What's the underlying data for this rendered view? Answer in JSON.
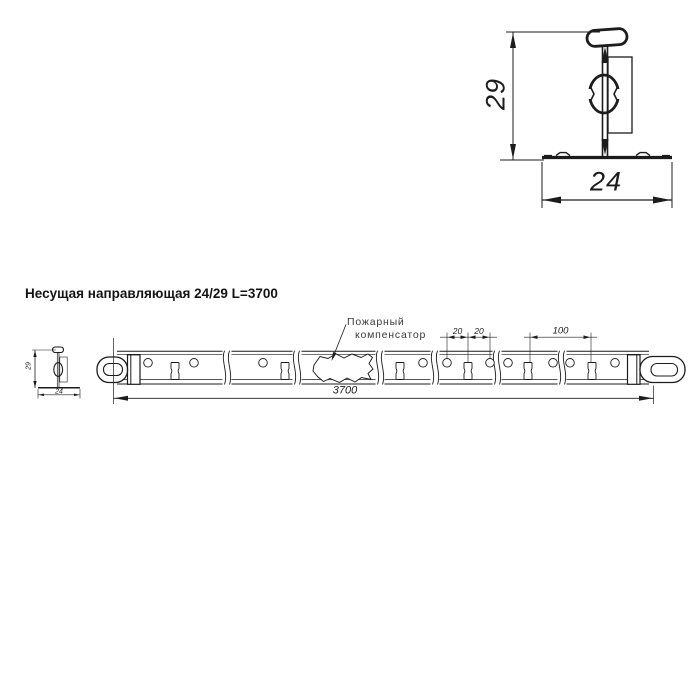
{
  "title": "Несущая направляющая 24/29 L=3700",
  "detail_view": {
    "height_mm": "29",
    "width_mm": "24"
  },
  "section_view": {
    "height_mm": "29",
    "width_mm": "24"
  },
  "callout": {
    "line1": "Пожарный",
    "line2": "компенсатор"
  },
  "dimensions": {
    "hole_pitch_1": "20",
    "hole_pitch_2": "20",
    "slot_pitch": "100",
    "overall_length": "3700"
  },
  "colors": {
    "line": "#1c1c1c",
    "background": "#ffffff",
    "callout_text": "#3a3a3a"
  }
}
